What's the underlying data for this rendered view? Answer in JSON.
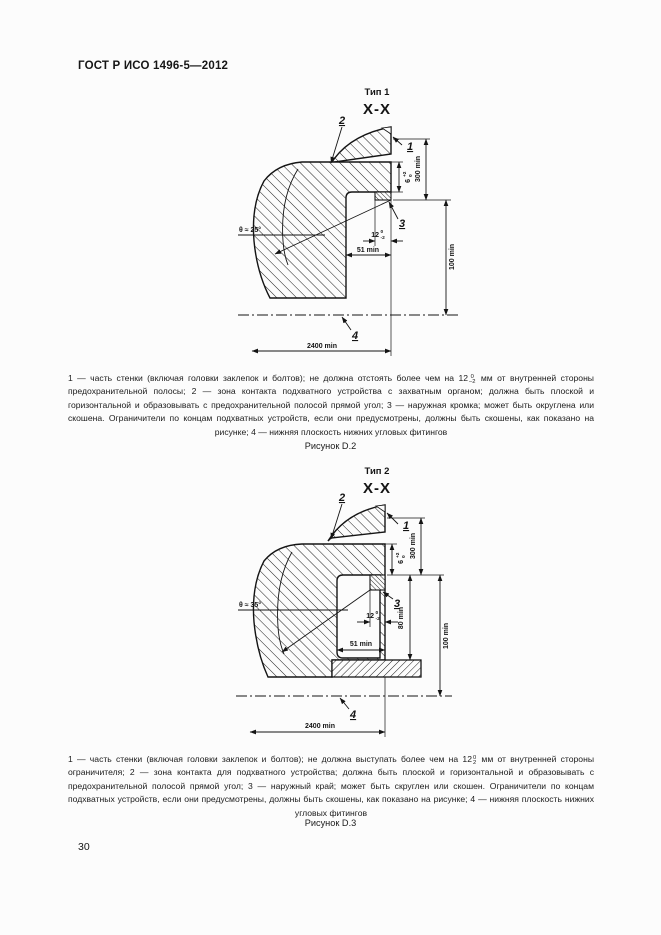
{
  "page": {
    "header": "ГОСТ Р ИСО 1496-5—2012",
    "page_number": "30"
  },
  "fig1": {
    "type_label": "Тип 1",
    "section": "X-X",
    "figure_caption": "Рисунок D.2",
    "angle": "θ ≈ 25°",
    "labels": {
      "l1": "1",
      "l2": "2",
      "l3": "3",
      "l4": "4"
    },
    "dims": {
      "d6": "6",
      "d6_top": "+2",
      "d6_bot": "0",
      "d300": "300 min",
      "d12": "12",
      "d12_top": "0",
      "d12_bot": "-2",
      "d51": "51 min",
      "d100": "100 min",
      "d2400": "2400 min"
    },
    "caption": {
      "part1": "1 — часть стенки (включая головки заклепок и болтов); не должна отстоять более чем на 12",
      "tol_top": "0",
      "tol_bot": "–2",
      "part2": " мм от внутренней стороны предохранительной полосы; 2 — зона контакта подхватного устройства с захватным органом; должна быть плоской и горизонтальной и образовывать с предохранительной полосой прямой угол; 3 — наружная кромка; может быть округлена или скошена. Ограничители по концам подхватных устройств, если они предусмотрены, должны быть скошены, как показано на рисунке; 4 — нижняя плоскость нижних угловых фитингов"
    }
  },
  "fig2": {
    "type_label": "Тип 2",
    "section": "X-X",
    "figure_caption": "Рисунок D.3",
    "angle": "θ ≈ 35°",
    "labels": {
      "l1": "1",
      "l2": "2",
      "l3": "3",
      "l4": "4"
    },
    "dims": {
      "d6": "6",
      "d6_top": "+2",
      "d6_bot": "0",
      "d300": "300 min",
      "d12": "12",
      "d12_top": "0",
      "d12_bot": "-2",
      "d51": "51 min",
      "d80": "80 min",
      "d100": "100 min",
      "d2400": "2400 min"
    },
    "caption": {
      "part1": "1 — часть стенки (включая головки заклепок и болтов); не должна выступать более чем на 12",
      "tol_top": "0",
      "tol_bot": "2",
      "part2": " мм от внутренней стороны ограничителя; 2 — зона контакта для подхватного устройства; должна быть плоской и горизонтальной и образовывать с предохранительной полосой прямой угол; 3 — наружный край; может быть скруглен или скошен. Ограничители по концам подхватных устройств, если они предусмотрены, должны быть скошены, как показано на рисунке; 4 — нижняя плоскость нижних угловых фитингов"
    }
  }
}
